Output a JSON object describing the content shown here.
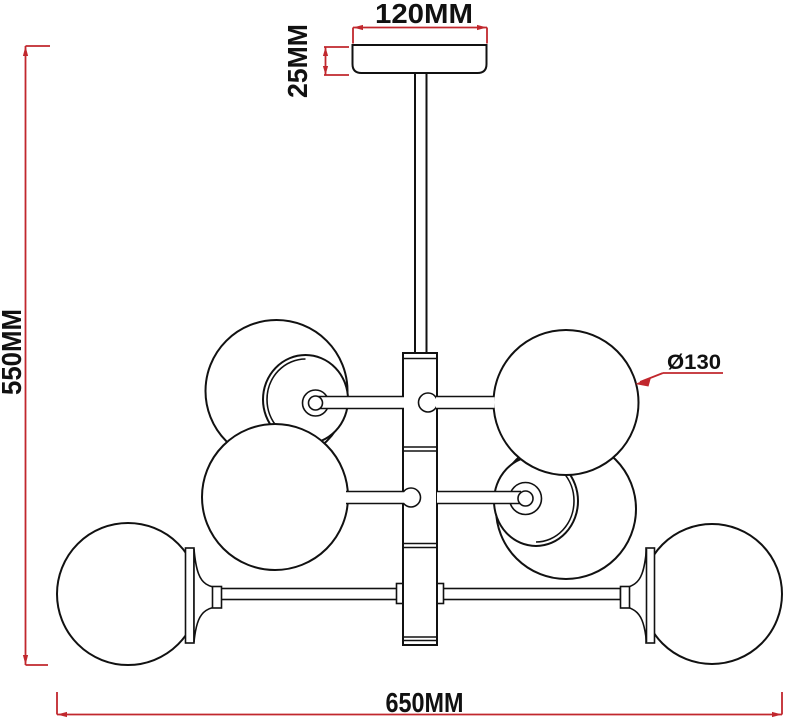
{
  "drawing": {
    "labels": {
      "canopy_width": "120MM",
      "canopy_height": "25MM",
      "overall_height": "550MM",
      "overall_width": "650MM",
      "globe_diameter": "Ø130"
    },
    "colors": {
      "dimension_red": "#c1272d",
      "line_black": "#111111",
      "background": "#ffffff"
    }
  }
}
